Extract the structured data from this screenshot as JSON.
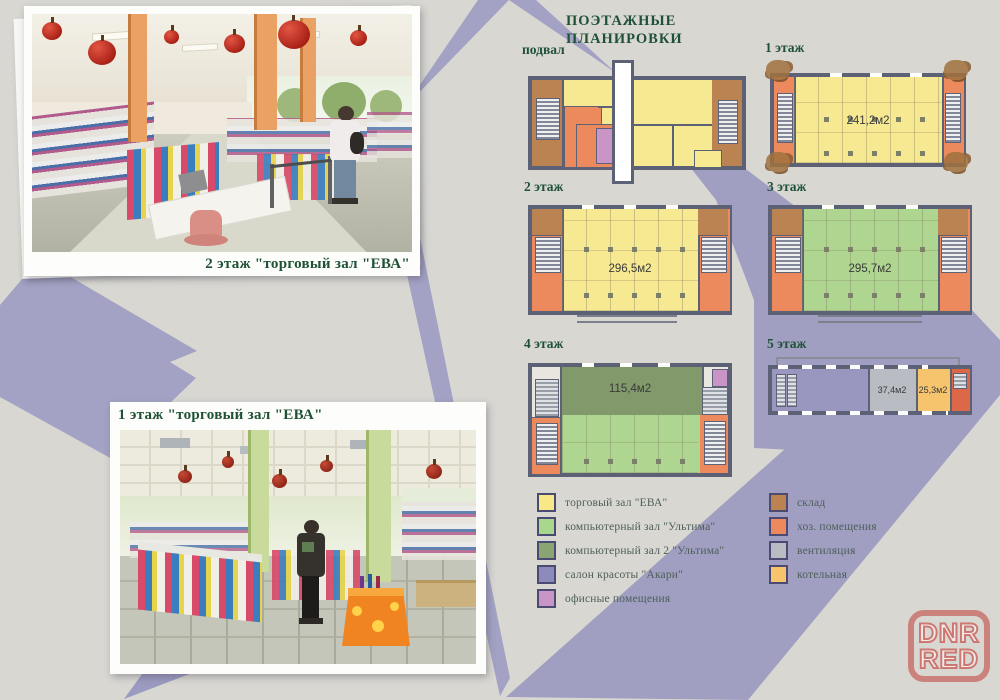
{
  "title": {
    "line1": "ПОЭТАЖНЫЕ",
    "line2": "ПЛАНИРОВКИ"
  },
  "photos": [
    {
      "caption": "2 этаж \"торговый зал \"ЕВА\""
    },
    {
      "caption": "1 этаж \"торговый зал \"ЕВА\""
    }
  ],
  "floors": [
    {
      "label": "подвал"
    },
    {
      "label": "1 этаж",
      "area": "241,2м2"
    },
    {
      "label": "2 этаж",
      "area": "296,5м2"
    },
    {
      "label": "3 этаж",
      "area": "295,7м2"
    },
    {
      "label": "4 этаж",
      "area": "115,4м2"
    },
    {
      "label": "5 этаж",
      "area1": "37,4м2",
      "area2": "25,3м2"
    }
  ],
  "legend": {
    "left": [
      {
        "label": "торговый зал \"ЕВА\"",
        "color": "#f8e886"
      },
      {
        "label": "компьютерный зал \"Ультима\"",
        "color": "#a9d78e"
      },
      {
        "label": "компьютерный зал 2 \"Ультима\"",
        "color": "#8ba473"
      },
      {
        "label": "салон красоты \"Акари\"",
        "color": "#8d8bbb"
      },
      {
        "label": "офисные помещения",
        "color": "#c995c6"
      }
    ],
    "right": [
      {
        "label": "склад",
        "color": "#ba8351"
      },
      {
        "label": "хоз. помещения",
        "color": "#ec8a5e"
      },
      {
        "label": "вентиляция",
        "color": "#b9bcc2"
      },
      {
        "label": "котельная",
        "color": "#f7c46e"
      }
    ]
  },
  "watermark": {
    "line1": "DNR",
    "line2": "RED"
  }
}
